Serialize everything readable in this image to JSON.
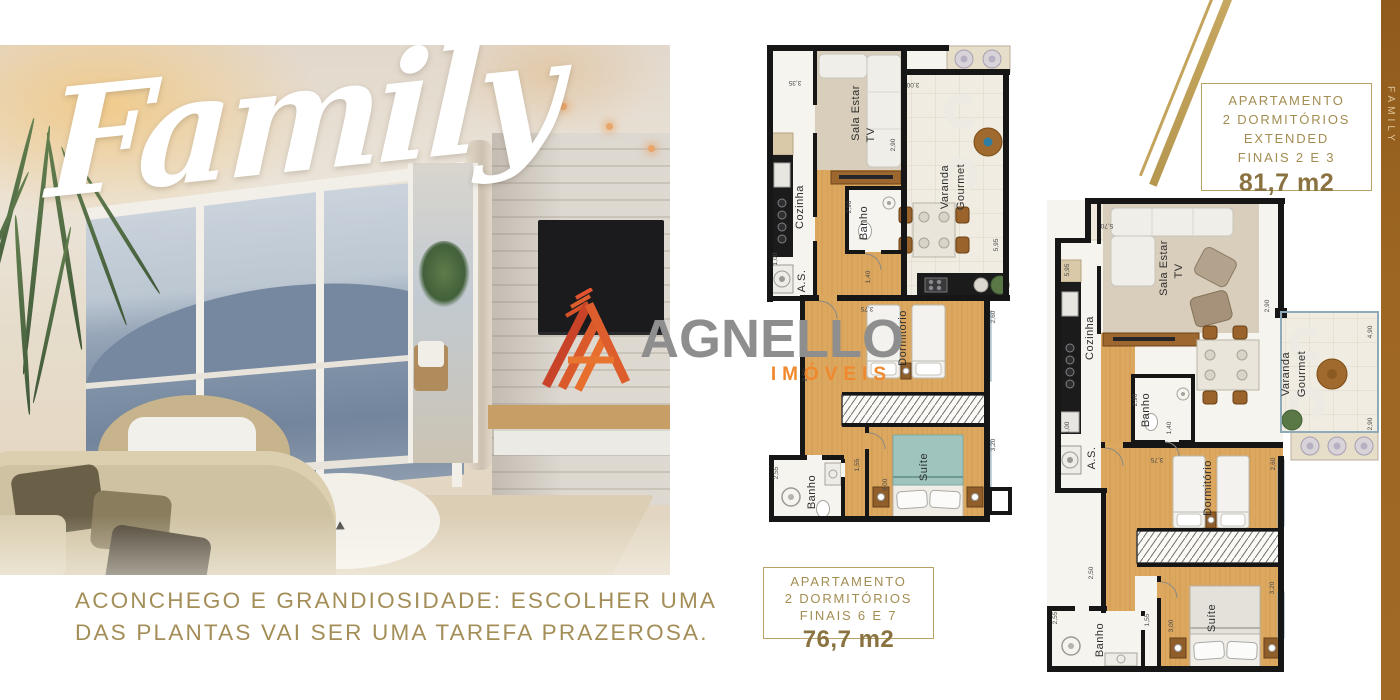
{
  "hero": {
    "title": "Family",
    "caption_line1": "ACONCHEGO E GRANDIOSIDADE: ESCOLHER UMA",
    "caption_line2": "DAS PLANTAS VAI SER UMA TAREFA PRAZEROSA."
  },
  "logo": {
    "name": "AGNELLO",
    "subtitle": "IMÓVEIS"
  },
  "side_tab": {
    "label": "FAMILY"
  },
  "plan_extended": {
    "label_box": {
      "line1": "APARTAMENTO",
      "line2": "2 DORMITÓRIOS",
      "line3": "EXTENDED",
      "line4": "FINAIS 2 E 3",
      "area": "81,7 m2"
    },
    "rooms": {
      "sala": "Sala Estar",
      "sala_tv": "TV",
      "varanda_1": "Varanda",
      "varanda_2": "Gourmet",
      "cozinha": "Cozinha",
      "area_servico": "A.S.",
      "banho_social": "Banho",
      "dormitorio": "Dormitório",
      "suite": "Suíte",
      "banho_suite": "Banho"
    },
    "dims": {
      "d1": "3,35",
      "d2": "3,00",
      "d3": "2,90",
      "d4": "5,95",
      "d5": "2,90",
      "d6": "1,40",
      "d7": "1,00",
      "d8": "3,75",
      "d9": "2,60",
      "d10": "2,50",
      "d11": "3,20",
      "d12": "2,55",
      "d13": "1,55",
      "d14": "3,00"
    }
  },
  "plan_standard": {
    "label_box": {
      "line1": "APARTAMENTO",
      "line2": "2 DORMITÓRIOS",
      "line3": "FINAIS 6 E 7",
      "area": "76,7 m2"
    },
    "rooms": {
      "sala": "Sala Estar",
      "sala_tv": "TV",
      "varanda_1": "Varanda",
      "varanda_2": "Gourmet",
      "cozinha": "Cozinha",
      "area_servico": "A.S.",
      "banho_social": "Banho",
      "dormitorio": "Dormitório",
      "suite": "Suíte",
      "banho_suite": "Banho"
    },
    "dims": {
      "d1": "5,70",
      "d2": "5,95",
      "d3": "1,00",
      "d4": "2,90",
      "d5": "2,90",
      "d6": "1,40",
      "d7": "4,90",
      "d8": "2,90",
      "d9": "3,75",
      "d10": "2,60",
      "d11": "2,50",
      "d12": "3,20",
      "d13": "3,00",
      "d14": "2,55",
      "d15": "1,55"
    }
  },
  "colors": {
    "gold_border": "#B9A268",
    "gold_text": "#A38D52",
    "area_text": "#8A7340",
    "strip_brown": "#9A6522",
    "logo_gray": "#8E8E8E",
    "logo_orange": "#F0882E",
    "wall_black": "#161616",
    "wood_floor": "#DCA75F",
    "carpet": "#D8CEBB"
  }
}
